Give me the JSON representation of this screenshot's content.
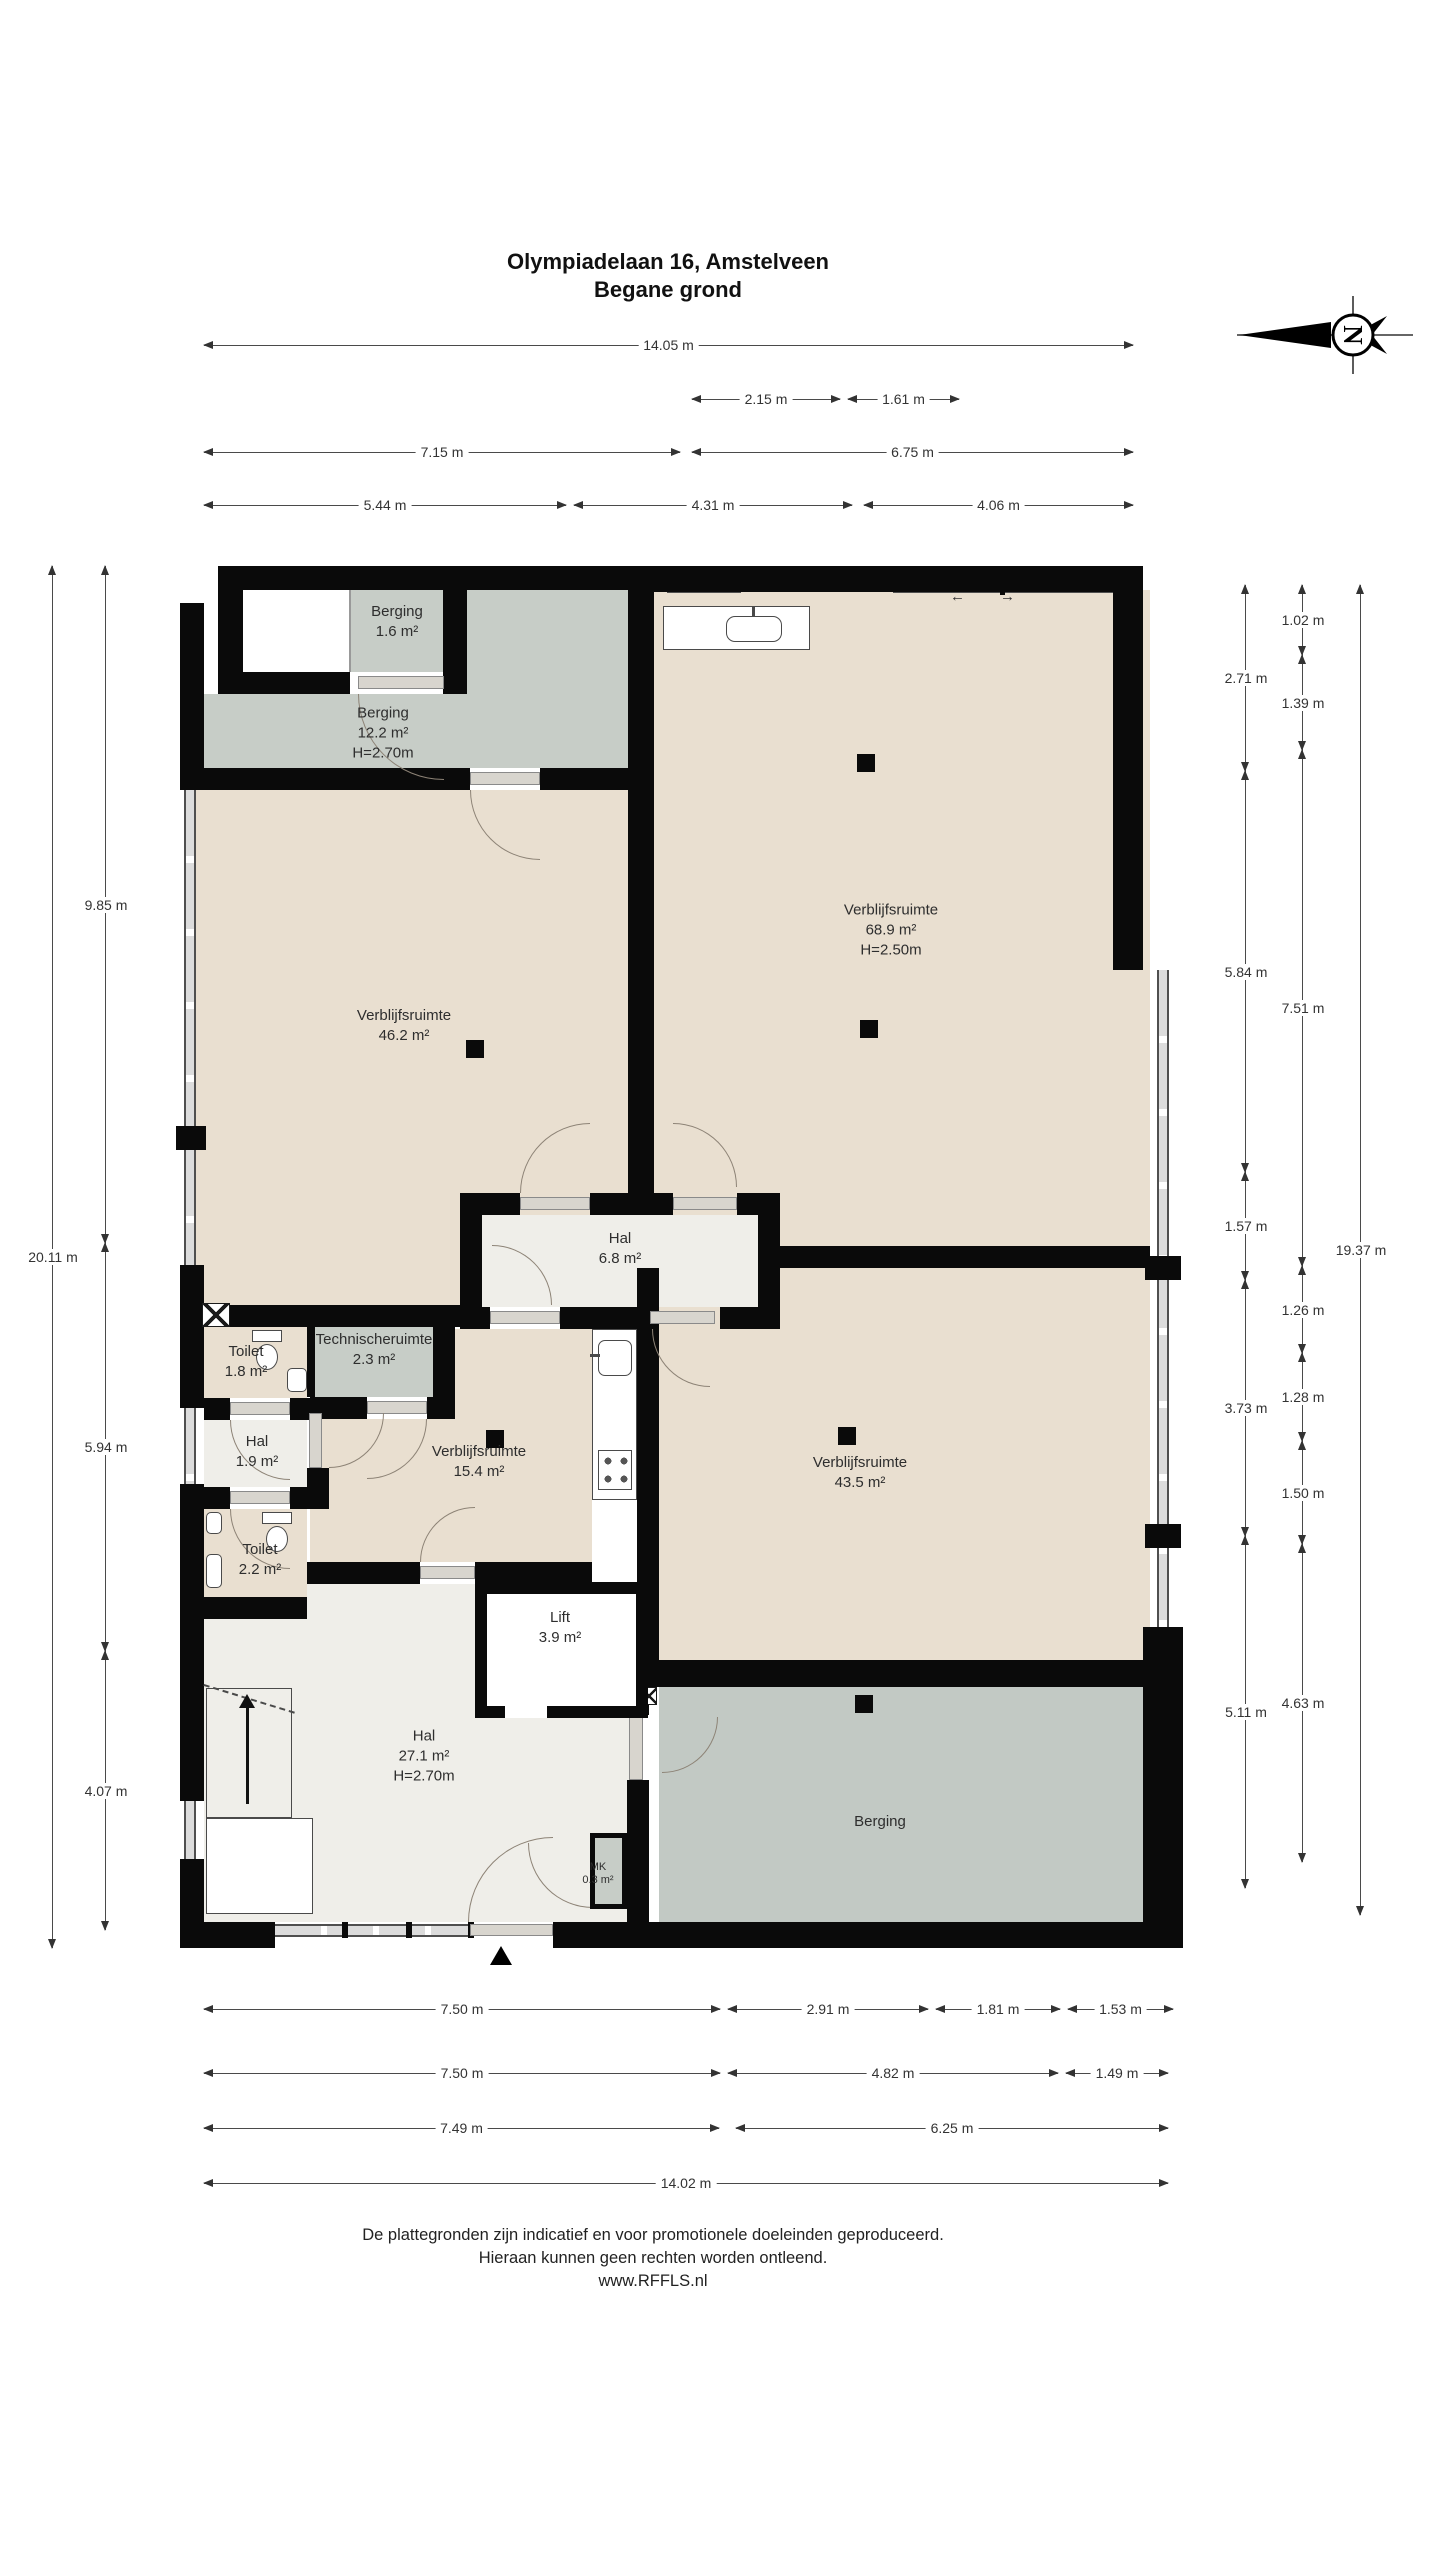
{
  "title": {
    "line1": "Olympiadelaan 16, Amstelveen",
    "line2": "Begane grond"
  },
  "compass": {
    "letter": "N"
  },
  "footer": {
    "line1": "De plattegronden zijn indicatief en voor promotionele doeleinden geproduceerd.",
    "line2": "Hieraan kunnen geen rechten worden ontleend.",
    "line3": "www.RFFLS.nl"
  },
  "colors": {
    "room_tan": "#e9dfd0",
    "storage_gray": "#c7cdc7",
    "storage_gray_dark": "#c2c9c4",
    "hall_light": "#efeee9",
    "white": "#ffffff",
    "wall": "#0a0a0a",
    "door_arc": "#8d8376",
    "dim_line": "#4a4a4a"
  },
  "rooms": [
    {
      "id": "berging-16",
      "name": "Berging",
      "area": "1.6 m²",
      "height": "",
      "cx": 397,
      "cy": 622
    },
    {
      "id": "berging-122",
      "name": "Berging",
      "area": "12.2 m²",
      "height": "H=2.70m",
      "cx": 383,
      "cy": 733
    },
    {
      "id": "verblijfsruimte-689",
      "name": "Verblijfsruimte",
      "area": "68.9 m²",
      "height": "H=2.50m",
      "cx": 891,
      "cy": 930
    },
    {
      "id": "verblijfsruimte-462",
      "name": "Verblijfsruimte",
      "area": "46.2 m²",
      "height": "",
      "cx": 404,
      "cy": 1026
    },
    {
      "id": "hal-68",
      "name": "Hal",
      "area": "6.8 m²",
      "height": "",
      "cx": 620,
      "cy": 1249
    },
    {
      "id": "toilet-18",
      "name": "Toilet",
      "area": "1.8 m²",
      "height": "",
      "cx": 246,
      "cy": 1362
    },
    {
      "id": "technischeruimte",
      "name": "Technischeruimte",
      "area": "2.3 m²",
      "height": "",
      "cx": 374,
      "cy": 1350
    },
    {
      "id": "hal-19",
      "name": "Hal",
      "area": "1.9 m²",
      "height": "",
      "cx": 257,
      "cy": 1452
    },
    {
      "id": "verblijfsruimte-154",
      "name": "Verblijfsruimte",
      "area": "15.4 m²",
      "height": "",
      "cx": 479,
      "cy": 1462
    },
    {
      "id": "verblijfsruimte-435",
      "name": "Verblijfsruimte",
      "area": "43.5 m²",
      "height": "",
      "cx": 860,
      "cy": 1473
    },
    {
      "id": "toilet-22",
      "name": "Toilet",
      "area": "2.2 m²",
      "height": "",
      "cx": 260,
      "cy": 1560
    },
    {
      "id": "lift",
      "name": "Lift",
      "area": "3.9 m²",
      "height": "",
      "cx": 560,
      "cy": 1628
    },
    {
      "id": "hal-271",
      "name": "Hal",
      "area": "27.1 m²",
      "height": "H=2.70m",
      "cx": 424,
      "cy": 1756
    },
    {
      "id": "berging-zuid",
      "name": "Berging",
      "area": "",
      "height": "",
      "cx": 880,
      "cy": 1822
    },
    {
      "id": "mk",
      "name": "MK",
      "area": "0.3 m²",
      "height": "",
      "cx": 598,
      "cy": 1874,
      "small": true
    }
  ],
  "dimensions": {
    "top": [
      {
        "label": "14.05 m",
        "x1": 204,
        "x2": 1133,
        "y": 345
      },
      {
        "label": "2.15 m",
        "x1": 692,
        "x2": 840,
        "y": 399
      },
      {
        "label": "1.61 m",
        "x1": 848,
        "x2": 959,
        "y": 399
      },
      {
        "label": "7.15 m",
        "x1": 204,
        "x2": 680,
        "y": 452
      },
      {
        "label": "6.75 m",
        "x1": 692,
        "x2": 1133,
        "y": 452
      },
      {
        "label": "5.44 m",
        "x1": 204,
        "x2": 566,
        "y": 505
      },
      {
        "label": "4.31 m",
        "x1": 574,
        "x2": 852,
        "y": 505
      },
      {
        "label": "4.06 m",
        "x1": 864,
        "x2": 1133,
        "y": 505
      }
    ],
    "bottom": [
      {
        "label": "7.50 m",
        "x1": 204,
        "x2": 720,
        "y": 2009
      },
      {
        "label": "2.91 m",
        "x1": 728,
        "x2": 928,
        "y": 2009
      },
      {
        "label": "1.81 m",
        "x1": 936,
        "x2": 1060,
        "y": 2009
      },
      {
        "label": "1.53 m",
        "x1": 1068,
        "x2": 1173,
        "y": 2009
      },
      {
        "label": "7.50 m",
        "x1": 204,
        "x2": 720,
        "y": 2073
      },
      {
        "label": "4.82 m",
        "x1": 728,
        "x2": 1058,
        "y": 2073
      },
      {
        "label": "1.49 m",
        "x1": 1066,
        "x2": 1168,
        "y": 2073
      },
      {
        "label": "7.49 m",
        "x1": 204,
        "x2": 719,
        "y": 2128
      },
      {
        "label": "6.25 m",
        "x1": 736,
        "x2": 1168,
        "y": 2128
      },
      {
        "label": "14.02 m",
        "x1": 204,
        "x2": 1168,
        "y": 2183
      }
    ],
    "left": [
      {
        "label": "20.11 m",
        "y1": 566,
        "y2": 1948,
        "x": 52
      },
      {
        "label": "9.85 m",
        "y1": 566,
        "y2": 1243,
        "x": 105
      },
      {
        "label": "5.94 m",
        "y1": 1243,
        "y2": 1651,
        "x": 105
      },
      {
        "label": "4.07 m",
        "y1": 1651,
        "y2": 1930,
        "x": 105
      }
    ],
    "right": [
      {
        "label": "2.71 m",
        "y1": 585,
        "y2": 771,
        "x": 1245
      },
      {
        "label": "5.84 m",
        "y1": 771,
        "y2": 1172,
        "x": 1245
      },
      {
        "label": "1.57 m",
        "y1": 1172,
        "y2": 1280,
        "x": 1245
      },
      {
        "label": "3.73 m",
        "y1": 1280,
        "y2": 1536,
        "x": 1245
      },
      {
        "label": "5.11 m",
        "y1": 1536,
        "y2": 1888,
        "x": 1245
      },
      {
        "label": "1.02 m",
        "y1": 585,
        "y2": 655,
        "x": 1302
      },
      {
        "label": "1.39 m",
        "y1": 655,
        "y2": 750,
        "x": 1302
      },
      {
        "label": "7.51 m",
        "y1": 750,
        "y2": 1266,
        "x": 1302
      },
      {
        "label": "1.26 m",
        "y1": 1266,
        "y2": 1353,
        "x": 1302
      },
      {
        "label": "1.28 m",
        "y1": 1353,
        "y2": 1441,
        "x": 1302
      },
      {
        "label": "1.50 m",
        "y1": 1441,
        "y2": 1544,
        "x": 1302
      },
      {
        "label": "4.63 m",
        "y1": 1544,
        "y2": 1862,
        "x": 1302
      },
      {
        "label": "19.37 m",
        "y1": 585,
        "y2": 1915,
        "x": 1360
      }
    ]
  },
  "annotations": {
    "sliding_door_left": "←",
    "sliding_door_right": "→",
    "entrance_marker": "entrance",
    "stairs_direction": "up"
  },
  "plan": {
    "fills": [
      {
        "name": "room-fill-niche",
        "color": "white",
        "r": [
          243,
          590,
          107,
          82
        ]
      },
      {
        "name": "room-fill-berging-16",
        "color": "storage_gray",
        "r": [
          350,
          590,
          93,
          82
        ]
      },
      {
        "name": "room-fill-berging-122a",
        "color": "storage_gray",
        "r": [
          467,
          590,
          161,
          104
        ]
      },
      {
        "name": "room-fill-berging-122b",
        "color": "storage_gray",
        "r": [
          204,
          694,
          424,
          74
        ]
      },
      {
        "name": "room-fill-689",
        "color": "room_tan",
        "r": [
          654,
          590,
          496,
          656
        ]
      },
      {
        "name": "room-fill-462",
        "color": "room_tan",
        "r": [
          196,
          790,
          432,
          515
        ]
      },
      {
        "name": "room-fill-435",
        "color": "room_tan",
        "r": [
          659,
          1268,
          491,
          397
        ]
      },
      {
        "name": "room-fill-hal68",
        "color": "hall_light",
        "r": [
          482,
          1215,
          276,
          92
        ]
      },
      {
        "name": "room-fill-toilet18",
        "color": "room_tan",
        "r": [
          204,
          1327,
          103,
          71
        ]
      },
      {
        "name": "room-fill-tech",
        "color": "storage_gray",
        "r": [
          315,
          1312,
          118,
          85
        ]
      },
      {
        "name": "room-fill-hal19",
        "color": "hall_light",
        "r": [
          204,
          1420,
          103,
          67
        ]
      },
      {
        "name": "room-fill-toilet22",
        "color": "room_tan",
        "r": [
          204,
          1509,
          103,
          88
        ]
      },
      {
        "name": "room-fill-154a",
        "color": "room_tan",
        "r": [
          433,
          1329,
          159,
          233
        ]
      },
      {
        "name": "room-fill-154b",
        "color": "room_tan",
        "r": [
          310,
          1419,
          123,
          143
        ]
      },
      {
        "name": "room-fill-hal271a",
        "color": "hall_light",
        "r": [
          204,
          1619,
          433,
          303
        ]
      },
      {
        "name": "room-fill-hal271b",
        "color": "hall_light",
        "r": [
          307,
          1584,
          168,
          35
        ]
      },
      {
        "name": "room-fill-berging-zuid",
        "color": "storage_gray_dark",
        "r": [
          659,
          1687,
          491,
          235
        ]
      }
    ],
    "glass": [
      {
        "o": "v",
        "r": [
          184,
          790,
          12,
          336
        ]
      },
      {
        "o": "v",
        "r": [
          184,
          1150,
          12,
          115
        ]
      },
      {
        "o": "v",
        "r": [
          184,
          1408,
          12,
          76
        ]
      },
      {
        "o": "v",
        "r": [
          184,
          1801,
          12,
          58
        ]
      },
      {
        "o": "v",
        "r": [
          1157,
          970,
          12,
          690
        ]
      },
      {
        "o": "h",
        "r": [
          667,
          580,
          74,
          13
        ]
      },
      {
        "o": "h",
        "r": [
          893,
          580,
          220,
          13
        ]
      },
      {
        "o": "h",
        "r": [
          275,
          1924,
          195,
          13
        ]
      }
    ],
    "walls": [
      [
        180,
        603,
        24,
        187
      ],
      [
        180,
        1265,
        24,
        143
      ],
      [
        180,
        1484,
        24,
        317
      ],
      [
        180,
        1859,
        24,
        89
      ],
      [
        176,
        1126,
        30,
        24
      ],
      [
        218,
        566,
        436,
        24
      ],
      [
        654,
        566,
        489,
        26
      ],
      [
        1113,
        566,
        30,
        404
      ],
      [
        1145,
        1256,
        36,
        24
      ],
      [
        1145,
        1524,
        36,
        24
      ],
      [
        1143,
        1627,
        40,
        321
      ],
      [
        180,
        1922,
        95,
        26
      ],
      [
        553,
        1922,
        590,
        26
      ],
      [
        218,
        590,
        25,
        104
      ],
      [
        218,
        672,
        132,
        22
      ],
      [
        443,
        588,
        24,
        106
      ],
      [
        628,
        590,
        26,
        625
      ],
      [
        204,
        768,
        266,
        22
      ],
      [
        540,
        768,
        88,
        22
      ],
      [
        460,
        1193,
        60,
        22
      ],
      [
        590,
        1193,
        83,
        22
      ],
      [
        737,
        1193,
        43,
        22
      ],
      [
        460,
        1193,
        22,
        136
      ],
      [
        758,
        1193,
        22,
        136
      ],
      [
        460,
        1307,
        30,
        22
      ],
      [
        560,
        1307,
        90,
        22
      ],
      [
        720,
        1307,
        60,
        22
      ],
      [
        780,
        1246,
        370,
        22
      ],
      [
        204,
        1305,
        256,
        22
      ],
      [
        307,
        1312,
        8,
        85
      ],
      [
        433,
        1312,
        22,
        107
      ],
      [
        204,
        1398,
        26,
        22
      ],
      [
        290,
        1398,
        20,
        22
      ],
      [
        310,
        1397,
        57,
        22
      ],
      [
        427,
        1397,
        10,
        22
      ],
      [
        307,
        1468,
        22,
        41
      ],
      [
        204,
        1487,
        26,
        22
      ],
      [
        290,
        1487,
        17,
        22
      ],
      [
        204,
        1597,
        103,
        22
      ],
      [
        307,
        1562,
        113,
        22
      ],
      [
        475,
        1562,
        117,
        22
      ],
      [
        637,
        1268,
        22,
        397
      ],
      [
        627,
        1665,
        22,
        50
      ],
      [
        627,
        1780,
        22,
        142
      ],
      [
        627,
        1833,
        22,
        89
      ],
      [
        649,
        1660,
        501,
        27
      ],
      [
        342,
        1922,
        6,
        16
      ],
      [
        406,
        1922,
        6,
        16
      ],
      [
        468,
        1922,
        6,
        16
      ],
      [
        1000,
        578,
        5,
        17
      ]
    ],
    "jambs": [
      [
        358,
        676,
        86,
        13
      ],
      [
        470,
        772,
        70,
        13
      ],
      [
        520,
        1197,
        70,
        13
      ],
      [
        673,
        1197,
        64,
        13
      ],
      [
        490,
        1311,
        70,
        13
      ],
      [
        650,
        1311,
        65,
        13
      ],
      [
        367,
        1401,
        60,
        13
      ],
      [
        230,
        1402,
        60,
        13
      ],
      [
        230,
        1491,
        60,
        13
      ],
      [
        420,
        1566,
        55,
        13
      ],
      [
        309,
        1413,
        13,
        55
      ],
      [
        629,
        1717,
        14,
        63
      ],
      [
        470,
        1924,
        83,
        12
      ]
    ],
    "arcs": [
      {
        "c": "bl",
        "r": [
          358,
          694,
          86,
          86
        ]
      },
      {
        "c": "bl",
        "r": [
          470,
          790,
          70,
          70
        ]
      },
      {
        "c": "tl",
        "r": [
          520,
          1123,
          70,
          70
        ]
      },
      {
        "c": "tr",
        "r": [
          673,
          1123,
          64,
          64
        ]
      },
      {
        "c": "tr",
        "r": [
          492,
          1245,
          60,
          60
        ]
      },
      {
        "c": "bl",
        "r": [
          652,
          1329,
          58,
          58
        ]
      },
      {
        "c": "br",
        "r": [
          367,
          1419,
          60,
          60
        ]
      },
      {
        "c": "bl",
        "r": [
          230,
          1420,
          60,
          60
        ]
      },
      {
        "c": "br",
        "r": [
          329,
          1413,
          55,
          55
        ]
      },
      {
        "c": "bl",
        "r": [
          230,
          1509,
          60,
          60
        ]
      },
      {
        "c": "tl",
        "r": [
          420,
          1507,
          55,
          55
        ]
      },
      {
        "c": "br",
        "r": [
          662,
          1717,
          56,
          56
        ]
      },
      {
        "c": "tl",
        "r": [
          468,
          1837,
          85,
          85
        ]
      },
      {
        "c": "bl",
        "r": [
          528,
          1843,
          65,
          65
        ]
      }
    ],
    "columns": [
      [
        466,
        1040
      ],
      [
        857,
        754
      ],
      [
        860,
        1020
      ],
      [
        486,
        1430
      ],
      [
        838,
        1427
      ],
      [
        855,
        1695
      ]
    ],
    "fixtures": [
      {
        "t": "counter",
        "name": "kitchen-counter",
        "r": [
          663,
          606,
          147,
          44
        ]
      },
      {
        "t": "csink",
        "name": "counter-sink",
        "r": [
          726,
          616,
          56,
          26
        ]
      },
      {
        "t": "faucet",
        "name": "counter-faucet",
        "r": [
          752,
          606,
          3,
          10
        ]
      },
      {
        "t": "tank",
        "name": "toilet-tank",
        "r": [
          252,
          1330,
          30,
          12
        ]
      },
      {
        "t": "bowl",
        "name": "toilet-bowl",
        "r": [
          256,
          1344,
          22,
          26
        ]
      },
      {
        "t": "sink",
        "name": "washbasin",
        "r": [
          287,
          1368,
          20,
          24
        ]
      },
      {
        "t": "tank",
        "name": "toilet-tank",
        "r": [
          262,
          1512,
          30,
          12
        ]
      },
      {
        "t": "bowl",
        "name": "toilet-bowl",
        "r": [
          266,
          1526,
          22,
          26
        ]
      },
      {
        "t": "sink",
        "name": "washbasin",
        "r": [
          206,
          1512,
          16,
          22
        ]
      },
      {
        "t": "sink",
        "name": "washbasin",
        "r": [
          206,
          1554,
          16,
          34
        ]
      },
      {
        "t": "kitchen",
        "name": "kitchen-unit",
        "r": [
          592,
          1329,
          45,
          171
        ]
      },
      {
        "t": "ksink",
        "name": "kitchen-sink",
        "r": [
          598,
          1340,
          34,
          36
        ]
      },
      {
        "t": "faucet",
        "name": "kitchen-faucet",
        "r": [
          590,
          1354,
          10,
          3
        ]
      },
      {
        "t": "cooktop",
        "name": "cooktop",
        "r": [
          598,
          1450,
          34,
          40
        ]
      }
    ],
    "xboxes": [
      [
        202,
        1303,
        28,
        24
      ],
      [
        641,
        1687,
        16,
        18
      ]
    ],
    "stairs": {
      "r": [
        206,
        1688,
        86,
        130
      ]
    },
    "understairs": {
      "r": [
        206,
        1818,
        107,
        96
      ]
    },
    "stair_diag": {
      "x": 204,
      "y": 1684,
      "len": 95,
      "angle": 17
    },
    "lift": {
      "r": [
        475,
        1582,
        173,
        136
      ],
      "gap": [
        505,
        1706,
        42,
        12
      ]
    },
    "mk": {
      "r": [
        590,
        1833,
        37,
        76
      ]
    },
    "niche_divider": [
      349,
      590,
      2,
      82
    ],
    "entrance_triangle": [
      490,
      1946
    ],
    "sliding_arrows": [
      {
        "x": 950,
        "y": 588,
        "key": "sliding_door_left"
      },
      {
        "x": 1000,
        "y": 588,
        "key": "sliding_door_right"
      }
    ]
  }
}
